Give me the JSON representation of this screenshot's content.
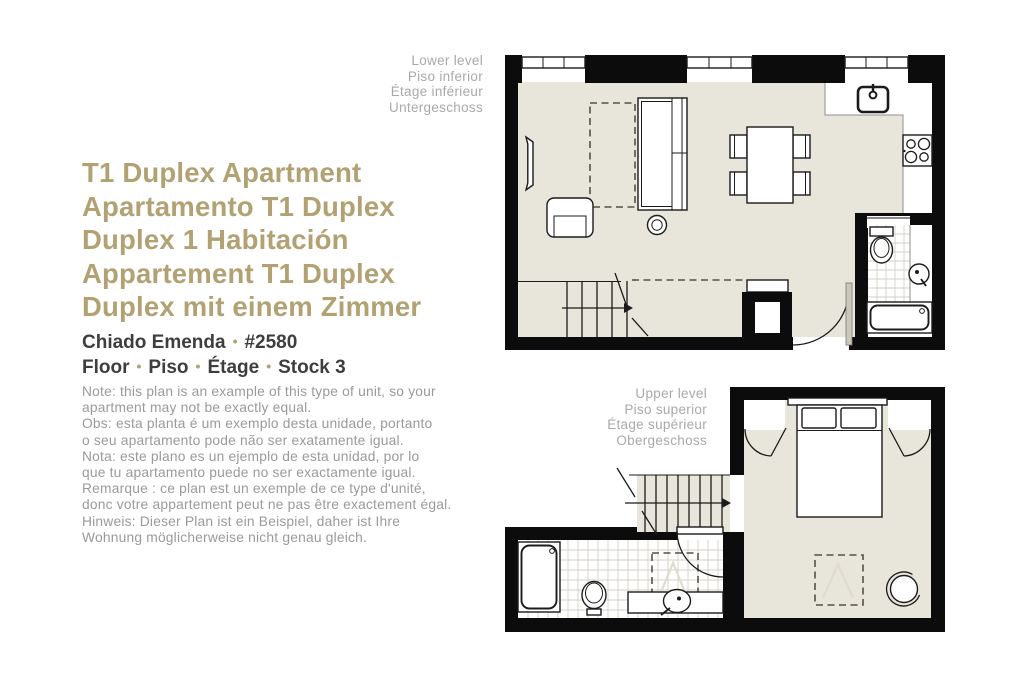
{
  "header": {
    "title_lines": [
      "T1 Duplex Apartment",
      "Apartamento T1 Duplex",
      "Duplex 1 Habitación",
      "Appartement T1 Duplex",
      "Duplex mit einem Zimmer"
    ],
    "property_name": "Chiado Emenda",
    "property_number": "#2580",
    "bullet": "•",
    "floor_items": [
      "Floor",
      "Piso",
      "Étage",
      "Stock 3"
    ]
  },
  "note_lines": [
    "Note: this plan is an example of this type of unit, so your",
    "apartment may not be exactly equal.",
    "Obs: esta planta é um exemplo desta unidade, portanto",
    "o seu apartamento pode não ser exatamente igual.",
    "Nota: este plano es un ejemplo de esta unidad, por lo",
    "que tu apartamento puede no ser exactamente igual.",
    "Remarque : ce plan est un exemple de ce type d'unité,",
    "donc votre appartement peut ne pas être exactement égal.",
    "Hinweis: Dieser Plan ist ein Beispiel, daher ist Ihre",
    "Wohnung möglicherweise nicht genau gleich."
  ],
  "plans": {
    "lower": {
      "labels": [
        "Lower level",
        "Piso inferior",
        "Étage inférieur",
        "Untergeschoss"
      ]
    },
    "upper": {
      "labels": [
        "Upper level",
        "Piso superior",
        "Étage supérieur",
        "Obergeschoss"
      ]
    }
  },
  "colors": {
    "accent": "#b1a173",
    "heading": "#3e3e3e",
    "note": "#9a9a9a",
    "level_label": "#a9a9a9",
    "floor_fill": "#e8e5da",
    "wall_fill": "#0c0c0c",
    "dash_outline": "#565145"
  }
}
